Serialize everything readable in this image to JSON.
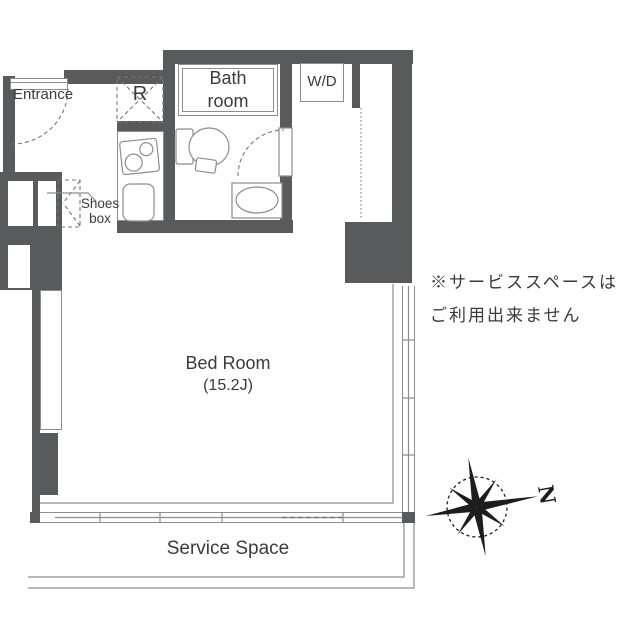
{
  "plan": {
    "rooms": {
      "entrance": {
        "label": "Entrance"
      },
      "refrigerator_space": {
        "label": "R"
      },
      "bathroom": {
        "label_line1": "Bath",
        "label_line2": "room"
      },
      "washer_dryer": {
        "label": "W/D"
      },
      "shoes_box": {
        "label_line1": "Shoes",
        "label_line2": "box"
      },
      "bedroom": {
        "label": "Bed Room",
        "size": "(15.2J)"
      },
      "service_space": {
        "label": "Service Space"
      }
    },
    "note": {
      "line1": "※サービススペースは",
      "line2": "ご利用出来ません"
    },
    "compass": {
      "label": "N"
    },
    "colors": {
      "wall": "#595a5c",
      "line": "#8d8d8d",
      "dash": "#777777",
      "text": "#3b3b3b",
      "compass": "#1d1d1d"
    }
  }
}
